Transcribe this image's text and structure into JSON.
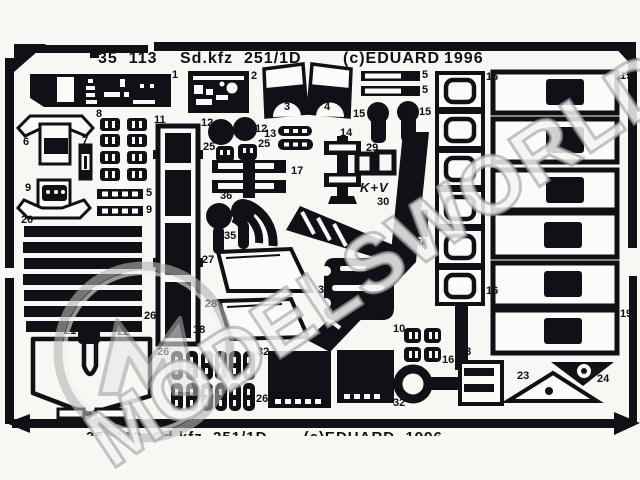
{
  "header": {
    "catalog_number": "35  113",
    "kit_name": "Sd.kfz  251/1D",
    "copyright": "(c)EDUARD",
    "year": "1996"
  },
  "footer": {
    "cropped_text": "35  113  Sd.kfz  251/1D       (c)EDUARD  1996"
  },
  "watermark": {
    "text": "MODELSWORLD",
    "logo": "m-monogram-circle"
  },
  "etch_markings": {
    "kv_logo": "K+V"
  },
  "colors": {
    "ink": "#101016",
    "background": "#f7f7f4",
    "watermark_gray": "#9a9a9a"
  },
  "fret": {
    "part_labels": [
      {
        "n": "1",
        "x": 172,
        "y": 70
      },
      {
        "n": "2",
        "x": 251,
        "y": 71
      },
      {
        "n": "3",
        "x": 284,
        "y": 102
      },
      {
        "n": "4",
        "x": 324,
        "y": 102
      },
      {
        "n": "5",
        "x": 422,
        "y": 70
      },
      {
        "n": "5",
        "x": 422,
        "y": 85
      },
      {
        "n": "5",
        "x": 146,
        "y": 188
      },
      {
        "n": "9",
        "x": 146,
        "y": 205
      },
      {
        "n": "6",
        "x": 23,
        "y": 137
      },
      {
        "n": "7",
        "x": 82,
        "y": 136
      },
      {
        "n": "8",
        "x": 96,
        "y": 109
      },
      {
        "n": "9",
        "x": 25,
        "y": 183
      },
      {
        "n": "10",
        "x": 393,
        "y": 324
      },
      {
        "n": "11",
        "x": 154,
        "y": 115
      },
      {
        "n": "12",
        "x": 201,
        "y": 118
      },
      {
        "n": "12",
        "x": 255,
        "y": 124
      },
      {
        "n": "13",
        "x": 264,
        "y": 129
      },
      {
        "n": "14",
        "x": 340,
        "y": 128
      },
      {
        "n": "15",
        "x": 353,
        "y": 109
      },
      {
        "n": "15",
        "x": 419,
        "y": 107
      },
      {
        "n": "16",
        "x": 486,
        "y": 72
      },
      {
        "n": "16",
        "x": 486,
        "y": 286
      },
      {
        "n": "16",
        "x": 442,
        "y": 355
      },
      {
        "n": "17",
        "x": 291,
        "y": 166
      },
      {
        "n": "18",
        "x": 193,
        "y": 325
      },
      {
        "n": "19",
        "x": 620,
        "y": 71
      },
      {
        "n": "19",
        "x": 620,
        "y": 309
      },
      {
        "n": "20",
        "x": 21,
        "y": 215
      },
      {
        "n": "21",
        "x": 64,
        "y": 326
      },
      {
        "n": "22",
        "x": 117,
        "y": 327
      },
      {
        "n": "23",
        "x": 517,
        "y": 371
      },
      {
        "n": "24",
        "x": 597,
        "y": 374
      },
      {
        "n": "25",
        "x": 203,
        "y": 142
      },
      {
        "n": "25",
        "x": 258,
        "y": 139
      },
      {
        "n": "26",
        "x": 144,
        "y": 311
      },
      {
        "n": "26",
        "x": 157,
        "y": 347
      },
      {
        "n": "26",
        "x": 256,
        "y": 394
      },
      {
        "n": "27",
        "x": 202,
        "y": 255
      },
      {
        "n": "28",
        "x": 205,
        "y": 299
      },
      {
        "n": "29",
        "x": 366,
        "y": 143
      },
      {
        "n": "30",
        "x": 377,
        "y": 197
      },
      {
        "n": "31",
        "x": 376,
        "y": 244
      },
      {
        "n": "32",
        "x": 257,
        "y": 347
      },
      {
        "n": "32",
        "x": 393,
        "y": 398
      },
      {
        "n": "33",
        "x": 459,
        "y": 347
      },
      {
        "n": "34",
        "x": 415,
        "y": 238
      },
      {
        "n": "35",
        "x": 224,
        "y": 231
      },
      {
        "n": "36",
        "x": 220,
        "y": 191
      },
      {
        "n": "37",
        "x": 318,
        "y": 285
      }
    ]
  }
}
